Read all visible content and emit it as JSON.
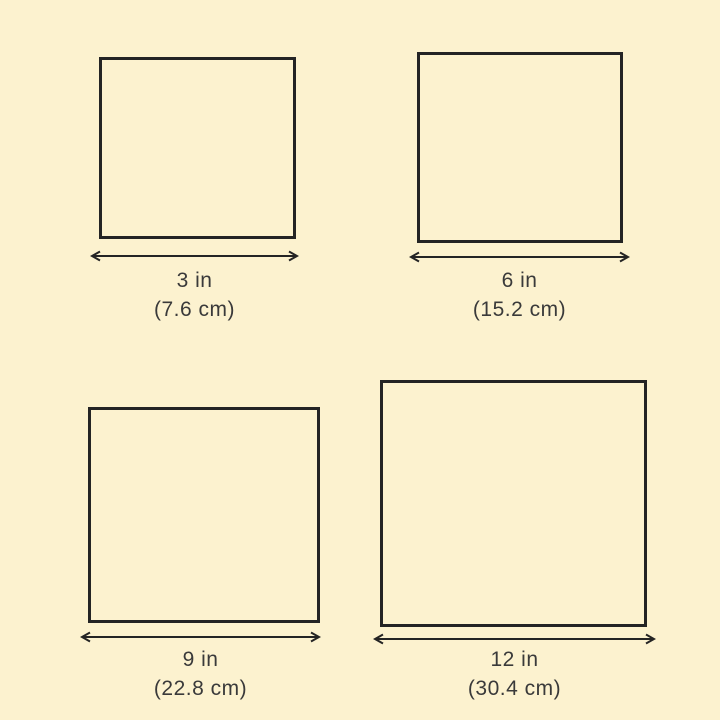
{
  "page": {
    "background_color": "#FCF2CF",
    "line_color": "#242424",
    "text_color": "#3A3A3A"
  },
  "squares": [
    {
      "name": "3-inch",
      "label_in": "3 in",
      "label_cm": "(7.6 cm)"
    },
    {
      "name": "6-inch",
      "label_in": "6 in",
      "label_cm": "(15.2 cm)"
    },
    {
      "name": "9-inch",
      "label_in": "9 in",
      "label_cm": "(22.8 cm)"
    },
    {
      "name": "12-inch",
      "label_in": "12 in",
      "label_cm": "(30.4 cm)"
    }
  ]
}
